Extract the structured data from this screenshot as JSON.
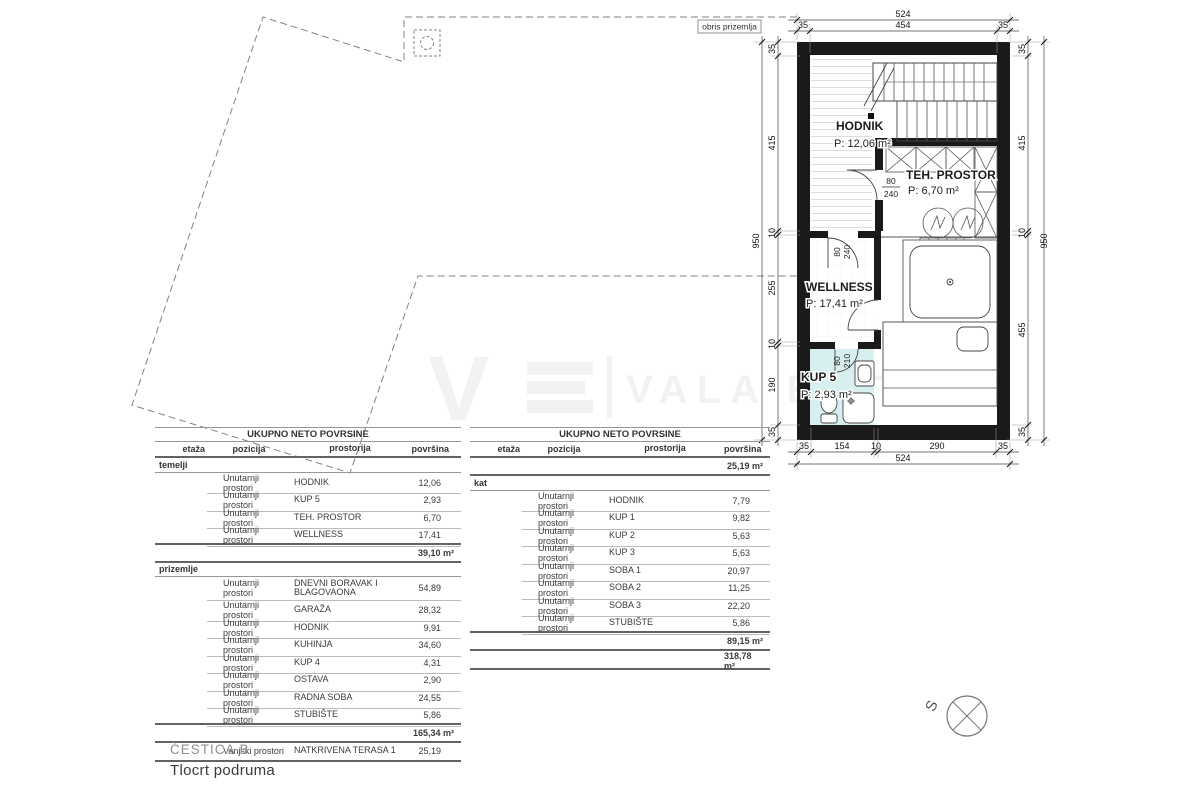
{
  "drawing": {
    "outline_label": "obris prizemlja",
    "watermark": {
      "logo_letter": "V",
      "text": "VALA ESTATE"
    },
    "compass_label": "S",
    "plan": {
      "rooms": [
        {
          "name": "HODNIK",
          "area": "P: 12,06 m²"
        },
        {
          "name": "TEH. PROSTOR",
          "area": "P: 6,70 m²"
        },
        {
          "name": "WELLNESS",
          "area": "P: 17,41 m²"
        },
        {
          "name": "KUP 5",
          "area": "P: 2,93 m²"
        }
      ],
      "doors": [
        {
          "width": "80",
          "height": "240"
        },
        {
          "width": "80",
          "height": "240"
        },
        {
          "width": "80",
          "height": "210"
        }
      ],
      "dims": {
        "top_total": "524",
        "top_segments": [
          "35",
          "454",
          "35"
        ],
        "bottom_total": "524",
        "bottom_segments": [
          "35",
          "154",
          "10",
          "290",
          "35"
        ],
        "left_total": "950",
        "left_segments": [
          "35",
          "415",
          "10",
          "255",
          "10",
          "190",
          "35"
        ],
        "right_total": "950",
        "right_segments": [
          "35",
          "415",
          "10",
          "455",
          "35"
        ]
      }
    }
  },
  "tables": {
    "left": {
      "title": "UKUPNO NETO POVRSINE",
      "columns": [
        "etaža",
        "pozicija",
        "prostorija",
        "površina"
      ],
      "sections": [
        {
          "name": "temelji",
          "rows": [
            {
              "pozicija": "Unutarnji prostori",
              "prostorija": "HODNIK",
              "povrsina": "12,06"
            },
            {
              "pozicija": "Unutarnji prostori",
              "prostorija": "KUP 5",
              "povrsina": "2,93"
            },
            {
              "pozicija": "Unutarnji prostori",
              "prostorija": "TEH. PROSTOR",
              "povrsina": "6,70"
            },
            {
              "pozicija": "Unutarnji prostori",
              "prostorija": "WELLNESS",
              "povrsina": "17,41"
            }
          ],
          "sum": "39,10 m²"
        },
        {
          "name": "prizemlje",
          "rows": [
            {
              "pozicija": "Unutarnji prostori",
              "prostorija": "DNEVNI BORAVAK I BLAGOVAONA",
              "povrsina": "54,89"
            },
            {
              "pozicija": "Unutarnji prostori",
              "prostorija": "GARAŽA",
              "povrsina": "28,32"
            },
            {
              "pozicija": "Unutarnji prostori",
              "prostorija": "HODNIK",
              "povrsina": "9,91"
            },
            {
              "pozicija": "Unutarnji prostori",
              "prostorija": "KUHINJA",
              "povrsina": "34,60"
            },
            {
              "pozicija": "Unutarnji prostori",
              "prostorija": "KUP 4",
              "povrsina": "4,31"
            },
            {
              "pozicija": "Unutarnji prostori",
              "prostorija": "OSTAVA",
              "povrsina": "2,90"
            },
            {
              "pozicija": "Unutarnji prostori",
              "prostorija": "RADNA SOBA",
              "povrsina": "24,55"
            },
            {
              "pozicija": "Unutarnji prostori",
              "prostorija": "STUBIŠTE",
              "povrsina": "5,86"
            }
          ],
          "sum": "165,34 m²"
        }
      ],
      "extra_row": {
        "pozicija": "Vanjski prostori",
        "prostorija": "NATKRIVENA TERASA 1",
        "povrsina": "25,19"
      }
    },
    "right": {
      "title": "UKUPNO NETO POVRSINE",
      "columns": [
        "etaža",
        "pozicija",
        "prostorija",
        "površina"
      ],
      "carry_sum": "25,19 m²",
      "sections": [
        {
          "name": "kat",
          "rows": [
            {
              "pozicija": "Unutarnji prostori",
              "prostorija": "HODNIK",
              "povrsina": "7,79"
            },
            {
              "pozicija": "Unutarnji prostori",
              "prostorija": "KUP 1",
              "povrsina": "9,82"
            },
            {
              "pozicija": "Unutarnji prostori",
              "prostorija": "KUP 2",
              "povrsina": "5,63"
            },
            {
              "pozicija": "Unutarnji prostori",
              "prostorija": "KUP 3",
              "povrsina": "5,63"
            },
            {
              "pozicija": "Unutarnji prostori",
              "prostorija": "SOBA 1",
              "povrsina": "20,97"
            },
            {
              "pozicija": "Unutarnji prostori",
              "prostorija": "SOBA 2",
              "povrsina": "11,25"
            },
            {
              "pozicija": "Unutarnji prostori",
              "prostorija": "SOBA 3",
              "povrsina": "22,20"
            },
            {
              "pozicija": "Unutarnji prostori",
              "prostorija": "STUBIŠTE",
              "povrsina": "5,86"
            }
          ],
          "sum": "89,15 m²"
        }
      ],
      "grand_total": "318,78 m²"
    }
  },
  "footer": {
    "parcel": "ČESTICA B",
    "title": "Tlocrt podruma"
  }
}
